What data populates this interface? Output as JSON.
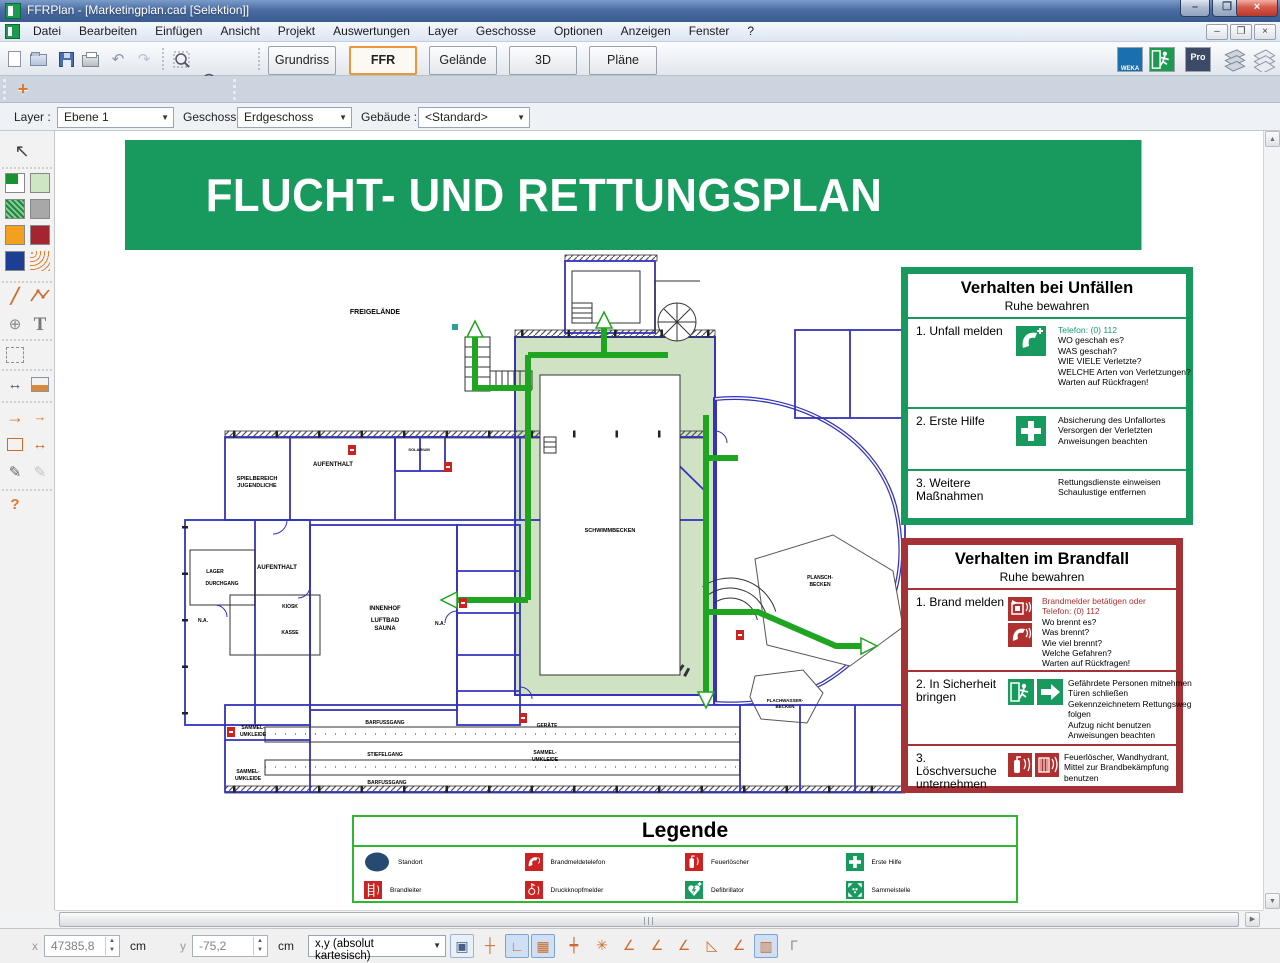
{
  "window": {
    "title": "FFRPlan - [Marketingplan.cad [Selektion]]"
  },
  "menubar": {
    "items": [
      "Datei",
      "Bearbeiten",
      "Einfügen",
      "Ansicht",
      "Projekt",
      "Auswertungen",
      "Layer",
      "Geschosse",
      "Optionen",
      "Anzeigen",
      "Fenster",
      "?"
    ]
  },
  "toolbar": {
    "tabs": [
      {
        "label": "Grundriss"
      },
      {
        "label": "FFR"
      },
      {
        "label": "Gelände"
      },
      {
        "label": "3D"
      },
      {
        "label": "Pläne"
      }
    ],
    "weka_label": "WEKA",
    "pro_label": "Pro"
  },
  "icons": {
    "undo": "↶",
    "redo": "↷",
    "plus": "+",
    "select": "↖",
    "circle": "⊕",
    "text": "T",
    "arrow": "→",
    "dim": "↔",
    "pipette": "✎",
    "question": "?",
    "line": "╱",
    "updown": "▲▼",
    "up": "▲",
    "down": "▼",
    "left": "◀",
    "right": "▶",
    "minimize": "–",
    "close": "×",
    "restore": "❐"
  },
  "filters": {
    "layer_label": "Layer :",
    "layer_value": "Ebene 1",
    "geschoss_label": "Geschoss",
    "geschoss_value": "Erdgeschoss",
    "gebaeude_label": "Gebäude :",
    "gebaeude_value": "<Standard>"
  },
  "plan": {
    "banner": "FLUCHT- UND RETTUNGSPLAN",
    "labels": {
      "freigelaende": "FREIGELÄNDE",
      "spielbereich_1": "SPIELBEREICH",
      "spielbereich_2": "JUGENDLICHE",
      "aufenthalt": "AUFENTHALT",
      "solarium": "SOLARIUM",
      "lager": "LAGER",
      "durchgang": "DURCHGANG",
      "kiosk": "KIOSK",
      "kasse": "KASSE",
      "innenhof": "INNENHOF",
      "luftbad": "LUFTBAD",
      "sauna": "SAUNA",
      "na": "N.A.",
      "schwimmbecken": "SCHWIMMBECKEN",
      "plansch_1": "PLANSCH-",
      "plansch_2": "BECKEN",
      "flach_1": "FLACHWASSER-",
      "flach_2": "BECKEN",
      "geraete": "GERÄTE",
      "sammel_1": "SAMMEL-",
      "sammel_2": "UMKLEIDE",
      "stiefelgang": "STIEFELGANG",
      "barfussgang": "BARFUSSGANG"
    }
  },
  "panels": {
    "accident": {
      "title": "Verhalten bei Unfällen",
      "subtitle": "Ruhe bewahren",
      "items": [
        {
          "num": "1.",
          "title": "Unfall melden",
          "lines": [
            "Telefon: (0) 112",
            "WO geschah es?",
            "WAS geschah?",
            "WIE VIELE Verletzte?",
            "WELCHE Arten von Verletzungen?",
            "Warten auf Rückfragen!"
          ]
        },
        {
          "num": "2.",
          "title": "Erste Hilfe",
          "lines": [
            "Absicherung des Unfallortes",
            "Versorgen der Verletzten",
            "Anweisungen beachten"
          ]
        },
        {
          "num": "3.",
          "title": "Weitere Maßnahmen",
          "lines": [
            "Rettungsdienste einweisen",
            "Schaulustige entfernen"
          ]
        }
      ]
    },
    "fire": {
      "title": "Verhalten im Brandfall",
      "subtitle": "Ruhe bewahren",
      "items": [
        {
          "num": "1.",
          "title": "Brand melden",
          "red_lines": [
            "Brandmelder betätigen oder",
            "Telefon: (0) 112"
          ],
          "lines": [
            "Wo brennt es?",
            "Was brennt?",
            "Wie viel brennt?",
            "Welche Gefahren?",
            "Warten auf Rückfragen!"
          ]
        },
        {
          "num": "2.",
          "title": "In Sicherheit bringen",
          "lines": [
            "Gefährdete Personen mitnehmen",
            "Türen schließen",
            "Gekennzeichnetem Rettungsweg",
            "folgen",
            "Aufzug nicht benutzen",
            "Anweisungen beachten"
          ]
        },
        {
          "num": "3.",
          "title": "Löschversuche unternehmen",
          "lines": [
            "Feuerlöscher, Wandhydrant,",
            "Mittel zur Brandbekämpfung",
            "benutzen"
          ]
        }
      ]
    }
  },
  "legend": {
    "title": "Legende",
    "items": [
      {
        "icon": "location-icon",
        "label": "Standort"
      },
      {
        "icon": "fire-phone-icon",
        "label": "Brandmeldetelefon"
      },
      {
        "icon": "extinguisher-icon",
        "label": "Feuerlöscher"
      },
      {
        "icon": "first-aid-icon",
        "label": "Erste Hilfe"
      },
      {
        "icon": "ladder-icon",
        "label": "Brandleiter"
      },
      {
        "icon": "push-button-icon",
        "label": "Druckknopfmelder"
      },
      {
        "icon": "defibrillator-icon",
        "label": "Defibrillator"
      },
      {
        "icon": "assembly-point-icon",
        "label": "Sammelstelle"
      }
    ]
  },
  "statusbar": {
    "x_label": "x",
    "x_value": "47385,8",
    "x_unit": "cm",
    "y_label": "y",
    "y_value": "-75,2",
    "y_unit": "cm",
    "mode": "x,y (absolut kartesisch)",
    "toggles": [
      {
        "name": "pointer-input-toggle",
        "glyph": "▣",
        "state": "framed"
      },
      {
        "name": "crosshair-toggle",
        "glyph": "┼",
        "state": ""
      },
      {
        "name": "ortho-toggle",
        "glyph": "∟",
        "state": "active"
      },
      {
        "name": "grid-toggle",
        "glyph": "▦",
        "state": "active"
      },
      {
        "name": "snap-center-toggle",
        "glyph": "┿",
        "state": ""
      },
      {
        "name": "snap-star-toggle",
        "glyph": "✳",
        "state": ""
      },
      {
        "name": "angle-dyn-toggle",
        "glyph": "∠",
        "state": ""
      },
      {
        "name": "angle-globe-toggle",
        "glyph": "∠",
        "state": ""
      },
      {
        "name": "angle-x-toggle",
        "glyph": "∠",
        "state": ""
      },
      {
        "name": "hatch-toggle",
        "glyph": "◺",
        "state": ""
      },
      {
        "name": "angle-arrow-toggle",
        "glyph": "∠",
        "state": ""
      },
      {
        "name": "ruler-toggle",
        "glyph": "▥",
        "state": "active"
      },
      {
        "name": "corner-ruler-toggle",
        "glyph": "Γ",
        "state": ""
      }
    ]
  }
}
